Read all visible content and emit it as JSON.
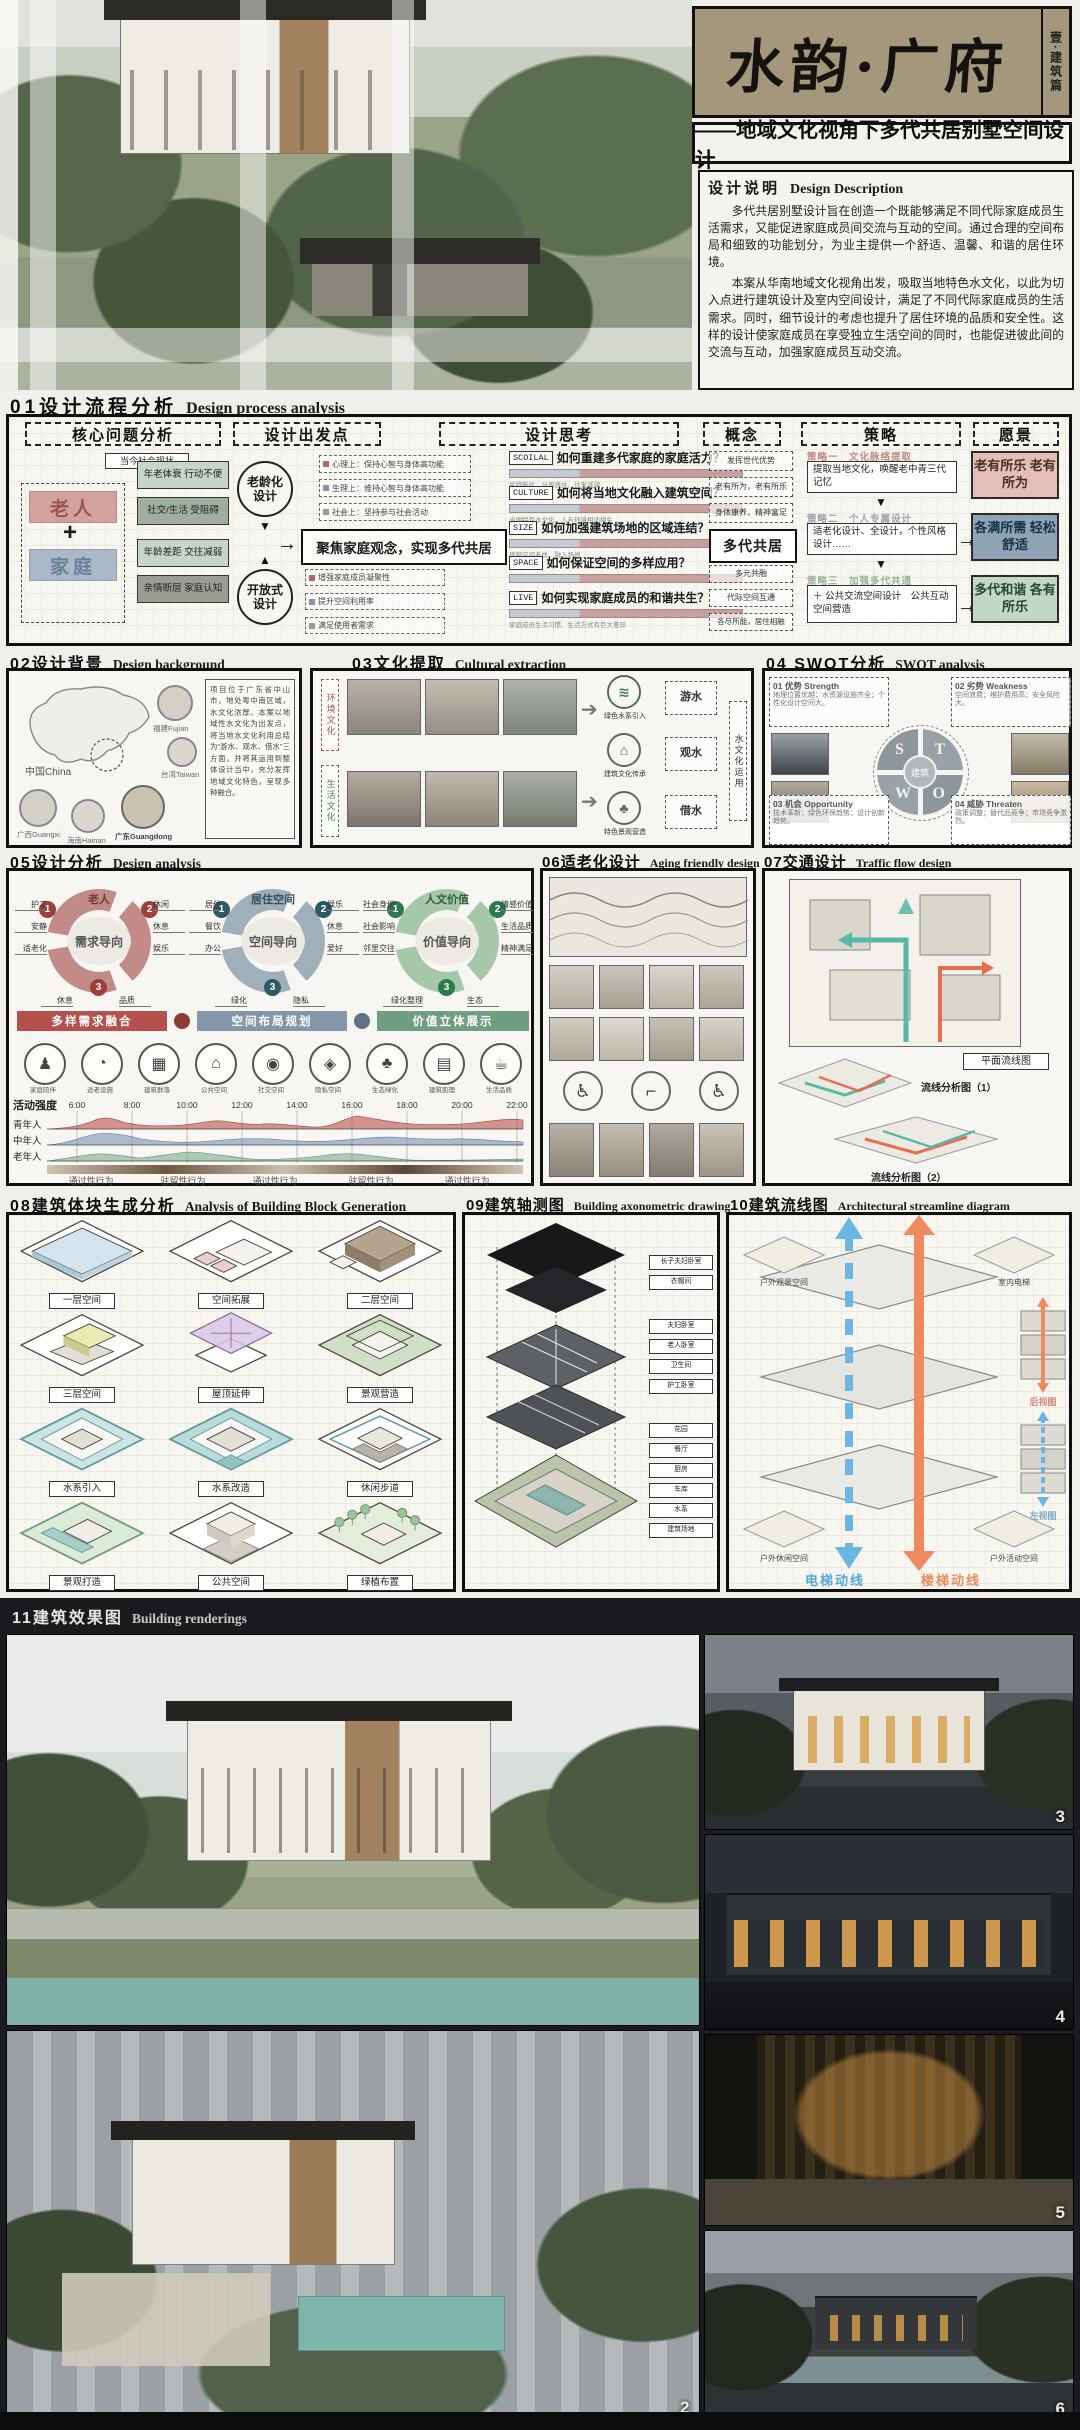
{
  "title_block": {
    "title": "水韵·广府",
    "edition": "壹·建筑篇",
    "subtitle": "——地域文化视角下多代共居别墅空间设计",
    "desc_zh": "设计说明",
    "desc_en": "Design Description",
    "desc_p1": "多代共居别墅设计旨在创造一个既能够满足不同代际家庭成员生活需求，又能促进家庭成员间交流与互动的空间。通过合理的空间布局和细致的功能划分，为业主提供一个舒适、温馨、和谐的居住环境。",
    "desc_p2": "本案从华南地域文化视角出发，吸取当地特色水文化，以此为切入点进行建筑设计及室内空间设计，满足了不同代际家庭成员的生活需求。同时，细节设计的考虑也提升了居住环境的品质和安全性。这样的设计使家庭成员在享受独立生活空间的同时，也能促进彼此间的交流与互动，加强家庭成员互动交流。"
  },
  "sections": {
    "s01": {
      "num": "01",
      "zh": "设计流程分析",
      "en": "Design process analysis"
    },
    "s02": {
      "num": "02",
      "zh": "设计背景",
      "en": "Design background"
    },
    "s03": {
      "num": "03",
      "zh": "文化提取",
      "en": "Cultural extraction"
    },
    "s04": {
      "num": "04 ",
      "zh": "SWOT分析",
      "en": "SWOT analysis"
    },
    "s05": {
      "num": "05",
      "zh": "设计分析",
      "en": "Design analysis"
    },
    "s06": {
      "num": "06",
      "zh": "适老化设计",
      "en": "Aging friendly design"
    },
    "s07": {
      "num": "07",
      "zh": "交通设计",
      "en": "Traffic flow design"
    },
    "s08": {
      "num": "08",
      "zh": "建筑体块生成分析",
      "en": "Analysis of Building Block Generation"
    },
    "s09": {
      "num": "09",
      "zh": "建筑轴测图",
      "en": "Building axonometric drawing"
    },
    "s10": {
      "num": "10",
      "zh": "建筑流线图",
      "en": "Architectural streamline diagram"
    },
    "s11": {
      "num": "11",
      "zh": "建筑效果图",
      "en": "Building renderings"
    }
  },
  "flow": {
    "headers": [
      "核心问题分析",
      "设计出发点",
      "设计思考",
      "概念",
      "策略",
      "愿景"
    ],
    "status": "当今社会现状",
    "elder": "老人",
    "plus": "+",
    "family": "家庭",
    "issues": [
      "年老体衰 行动不便",
      "社交/生活 受阻碍",
      "年龄差距 交往减弱",
      "亲情断层 家庭认知"
    ],
    "aging_circle": "老龄化设计",
    "open_circle": "开放式设计",
    "down_arrow": "▼",
    "up_arrow": "▲",
    "starts": [
      "心理上：保持心智与身体高功能",
      "生理上：维持心智与身体高功能",
      "社会上：坚持参与社会活动"
    ],
    "gains": [
      "增强家庭成员凝聚性",
      "提升空间利用率",
      "满足使用者需求"
    ],
    "focus": "聚焦家庭观念，实现多代共居",
    "questions": [
      {
        "tag": "SCOILAL",
        "q": "如何重建多代家庭的家庭活力？",
        "note": "家庭断代、分离居住、往来减弱"
      },
      {
        "tag": "CULTURE",
        "q": "如何将当地文化融入建筑空间？",
        "note": "当地特有水文化、人与环境相适相生"
      },
      {
        "tag": "SIZE",
        "q": "如何加强建筑场地的区域连结？",
        "note": "建筑空间多样、融入场地"
      },
      {
        "tag": "SPACE",
        "q": "如何保证空间的多样应用？",
        "note": "需求多样、建筑空间功能单一"
      },
      {
        "tag": "LIVE",
        "q": "如何实现家庭成员的和谐共生？",
        "note": "家庭成员生活习惯、生活方式有巨大差异"
      }
    ],
    "concepts": [
      "发挥世代优势",
      "老有所为，老有所乐",
      "身体康养，精神富足"
    ],
    "concept_main": "多代共居",
    "concepts2": [
      "多元共融",
      "代际空间互通",
      "各尽所能，居住相融"
    ],
    "strategies": [
      {
        "label": "策略一　文化脉络提取",
        "box": "提取当地文化，唤醒老中青三代记忆"
      },
      {
        "label": "策略二　个人专属设计",
        "box": "适老化设计、全设计，个性风格设计……"
      },
      {
        "label": "策略三　加强多代共通",
        "box": "＋ 公共交流空间设计　公共互动空间营造"
      }
    ],
    "visions": [
      "老有所乐 老有所为",
      "各满所需 轻松舒适",
      "多代和谐 各有所乐"
    ]
  },
  "background02": {
    "regions": [
      "中国China",
      "福建Fujian",
      "台湾Taiwan",
      "广西Guangxi",
      "海南Hainan",
      "广东Guangdong"
    ],
    "note": "项目位于广东省中山市，地处粤中南区域，水文化浓厚。本案以地域性水文化为出发点，将当地水文化利用总结为“游水、观水、借水”三方面，并将其运用到整体设计当中，充分发挥地域文化特色，呈现多种融合。"
  },
  "culture03": {
    "tags": [
      "环境文化",
      "生活文化"
    ],
    "apply_tag": "水文化运用",
    "groups": [
      {
        "icon": "≋",
        "label": "绿色水系引入",
        "key": "游水"
      },
      {
        "icon": "⌂",
        "label": "建筑文化传承",
        "key": "观水"
      },
      {
        "icon": "♣",
        "label": "特色景观营造",
        "key": "借水"
      }
    ]
  },
  "swot04": {
    "s_title": "01 优势 Strength",
    "s_items": "地理位置优越；水资源设施齐全；个性化设计空间大。",
    "w_title": "02 劣势 Weakness",
    "w_items": "空间浪费；维护费用高；安全风险大。",
    "o_title": "03 机会 Opportunity",
    "o_items": "技术革新；绿色环保趋势；设计创新趋势。",
    "t_title": "04 威胁 Threaten",
    "t_items": "政策调整；替代品竞争；市场竞争激烈。",
    "letters": [
      "S",
      "T",
      "W",
      "O"
    ],
    "center": "建筑"
  },
  "analysis05": {
    "rings": [
      {
        "title": "老人",
        "center": "需求导向",
        "left": [
          "护工",
          "安静",
          "适老化"
        ],
        "right": [
          "休闲",
          "休息",
          "娱乐"
        ],
        "bottom": [
          "休息",
          "品质"
        ],
        "nums": [
          "1",
          "2",
          "3"
        ]
      },
      {
        "title": "居住空间",
        "center": "空间导向",
        "left": [
          "居住",
          "餐饮",
          "办公"
        ],
        "right": [
          "娱乐",
          "休息",
          "爱好"
        ],
        "bottom": [
          "绿化",
          "隐私"
        ],
        "nums": [
          "1",
          "2",
          "3"
        ]
      },
      {
        "title": "人文价值",
        "center": "价值导向",
        "left": [
          "社会身份",
          "社会影响",
          "邻里交往"
        ],
        "right": [
          "情感价值",
          "生活品质",
          "精神满足"
        ],
        "bottom": [
          "绿化整理",
          "生态"
        ],
        "nums": [
          "1",
          "2",
          "3"
        ]
      }
    ],
    "bars": [
      "多样需求融合",
      "空间布局规划",
      "价值立体展示"
    ],
    "icons": [
      {
        "glyph": "♟",
        "label": "家庭陪伴"
      },
      {
        "glyph": "◔",
        "label": "适老设施"
      },
      {
        "glyph": "▦",
        "label": "建筑群落"
      },
      {
        "glyph": "⌂",
        "label": "公共空间"
      },
      {
        "glyph": "◉",
        "label": "社交空间"
      },
      {
        "glyph": "◈",
        "label": "隐私空间"
      },
      {
        "glyph": "♣",
        "label": "生态绿化"
      },
      {
        "glyph": "▤",
        "label": "建筑肌理"
      },
      {
        "glyph": "☕",
        "label": "生活品质"
      }
    ],
    "chart": {
      "y_label": "活动强度",
      "times": [
        "6:00",
        "8:00",
        "10:00",
        "12:00",
        "14:00",
        "16:00",
        "18:00",
        "20:00",
        "22:00"
      ],
      "rows": [
        "青年人",
        "中年人",
        "老年人"
      ],
      "behaviors": [
        "通过性行为",
        "驻留性行为",
        "通过性行为",
        "驻留性行为",
        "通过性行为"
      ]
    }
  },
  "traffic07": {
    "plan_label": "平面流线图",
    "iso1_label": "流线分析图（1）",
    "iso2_label": "流线分析图（2）"
  },
  "blocks08": {
    "labels": [
      "一层空间",
      "空间拓展",
      "二层空间",
      "三层空间",
      "屋顶延伸",
      "景观营造",
      "水系引入",
      "水系改造",
      "休闲步道",
      "景观打造",
      "公共空间",
      "绿植布置"
    ]
  },
  "axon09": {
    "labels": [
      "长子夫妇卧室",
      "衣帽间",
      "夫妇卧室",
      "老人卧室",
      "卫生间",
      "护工卧室",
      "花园",
      "餐厅",
      "厨房",
      "车库",
      "水系",
      "建筑场地"
    ]
  },
  "flow10": {
    "corners": [
      "户外观景空间",
      "室内电梯",
      "户外休闲空间",
      "户外活动空间"
    ],
    "legend_blue": "电梯动线",
    "legend_orange": "楼梯动线",
    "views": [
      "后视图",
      "左视图"
    ]
  },
  "renderings11": {
    "numbers": [
      "2",
      "3",
      "4",
      "5",
      "6"
    ]
  }
}
